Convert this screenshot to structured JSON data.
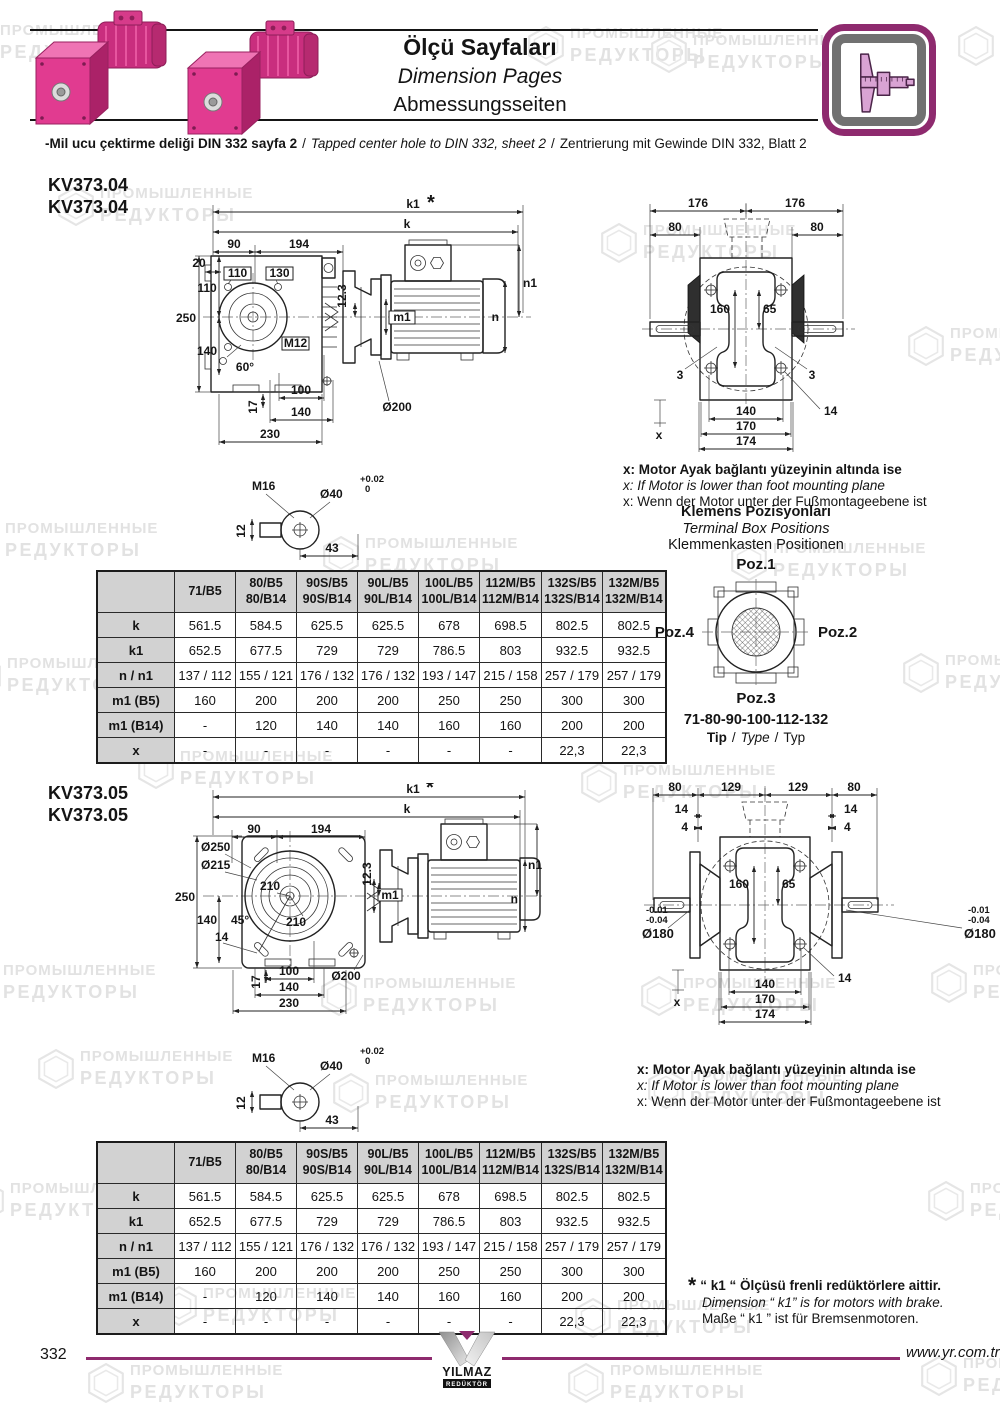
{
  "sep": "/",
  "colors": {
    "accent_purple": "#8e2a6e",
    "motor_pink": "#e13b90",
    "table_header_bg": "#d2d2d2",
    "watermark_gray": "#e2e2e2",
    "line_black": "#151515"
  },
  "watermark": {
    "l1": "ПРОМЫШЛЕННЫЕ",
    "l2": "РЕДУКТОРЫ"
  },
  "header": {
    "title_tr": "Ölçü Sayfaları",
    "title_en": "Dimension Pages",
    "title_de": "Abmessungsseiten",
    "note_tr": "-Mil ucu çektirme deliği DIN 332 sayfa 2",
    "note_en": "Tapped center hole to DIN 332, sheet 2",
    "note_de": "Zentrierung mit Gewinde DIN 332, Blatt 2"
  },
  "models": {
    "kv04": {
      "name": "KV373.04",
      "name2": "KV373.04"
    },
    "kv05": {
      "name": "KV373.05",
      "name2": "KV373.05"
    }
  },
  "x_note": {
    "tr": "x: Motor Ayak bağlantı yüzeyinin altında ise",
    "en": "x: If Motor is lower than foot mounting plane",
    "de": "x: Wenn der Motor unter der Fußmontageebene ist"
  },
  "terminal": {
    "title_tr": "Klemens Pozisyonları",
    "title_en": "Terminal Box Positions",
    "title_de": "Klemmenkasten Positionen",
    "poz1": "Poz.1",
    "poz2": "Poz.2",
    "poz3": "Poz.3",
    "poz4": "Poz.4",
    "sizes": "71-80-90-100-112-132",
    "tip": "Tip",
    "type": "Type",
    "typ": "Typ"
  },
  "footnote": {
    "star": "*",
    "tr": "“ k1 “ Ölçüsü frenli redüktörlere aittir.",
    "en": "Dimension “ k1” is for motors with brake.",
    "de": "Maße “ k1 ” ist für Bremsenmotoren."
  },
  "footer": {
    "page": "332",
    "url": "www.yr.com.tr"
  },
  "logo": {
    "name": "YILMAZ",
    "sub": "REDÜKTÖR"
  },
  "dim_table": {
    "headers": [
      "",
      "71/B5",
      "80/B5\n80/B14",
      "90S/B5\n90S/B14",
      "90L/B5\n90L/B14",
      "100L/B5\n100L/B14",
      "112M/B5\n112M/B14",
      "132S/B5\n132S/B14",
      "132M/B5\n132M/B14"
    ],
    "rows": [
      {
        "label": "k",
        "values": [
          "561.5",
          "584.5",
          "625.5",
          "625.5",
          "678",
          "698.5",
          "802.5",
          "802.5"
        ]
      },
      {
        "label": "k1",
        "values": [
          "652.5",
          "677.5",
          "729",
          "729",
          "786.5",
          "803",
          "932.5",
          "932.5"
        ]
      },
      {
        "label": "n / n1",
        "values": [
          "137 / 112",
          "155 / 121",
          "176 / 132",
          "176 / 132",
          "193 / 147",
          "215 / 158",
          "257 / 179",
          "257 / 179"
        ]
      },
      {
        "label": "m1 (B5)",
        "values": [
          "160",
          "200",
          "200",
          "200",
          "250",
          "250",
          "300",
          "300"
        ]
      },
      {
        "label": "m1 (B14)",
        "values": [
          "-",
          "120",
          "140",
          "140",
          "160",
          "160",
          "200",
          "200"
        ]
      },
      {
        "label": "x",
        "values": [
          "-",
          "-",
          "-",
          "-",
          "-",
          "-",
          "22,3",
          "22,3"
        ]
      }
    ]
  },
  "dw_a": {
    "star": "*",
    "k1": "k1",
    "k": "k",
    "d90": "90",
    "d194": "194",
    "d20": "20",
    "b110": "110",
    "b130": "130",
    "v110": "110",
    "v250": "250",
    "v140": "140",
    "a60": "60°",
    "m12": "M12",
    "d123": "12.3",
    "m1": "m1",
    "n1": "n1",
    "n": "n",
    "d200": "Ø200",
    "r17": "17",
    "b100": "100",
    "b140": "140",
    "b230": "230"
  },
  "dw_b": {
    "d176a": "176",
    "d176b": "176",
    "d80a": "80",
    "d80b": "80",
    "d160": "160",
    "d65": "65",
    "d3a": "3",
    "d3b": "3",
    "d14": "14",
    "x": "x",
    "b140": "140",
    "b170": "170",
    "b174": "174"
  },
  "dw_shaft": {
    "m16": "M16",
    "d40": "Ø40",
    "tol1": "+0.02",
    "tol2": "0",
    "d12": "12",
    "d43": "43"
  },
  "dw_e": {
    "star": "*",
    "k1": "k1",
    "k": "k",
    "d90": "90",
    "d194": "194",
    "d250": "Ø250",
    "d215": "Ø215",
    "d210a": "210",
    "d210b": "210",
    "v250": "250",
    "v140": "140",
    "a45": "45°",
    "d14": "14",
    "d123": "12.3",
    "m1": "m1",
    "n1": "n1",
    "n": "n",
    "d200": "Ø200",
    "r17": "17",
    "b100": "100",
    "b140": "140",
    "b230": "230"
  },
  "dw_f": {
    "d80a": "80",
    "d129a": "129",
    "d129b": "129",
    "d80b": "80",
    "d14a": "14",
    "d4a": "4",
    "d14b": "14",
    "d4b": "4",
    "d160": "160",
    "d65": "65",
    "tolh1": "-0.01",
    "tolh2": "-0.04",
    "d180a": "Ø180",
    "d180b": "Ø180",
    "d14c": "14",
    "x": "x",
    "b140": "140",
    "b170": "170",
    "b174": "174"
  }
}
